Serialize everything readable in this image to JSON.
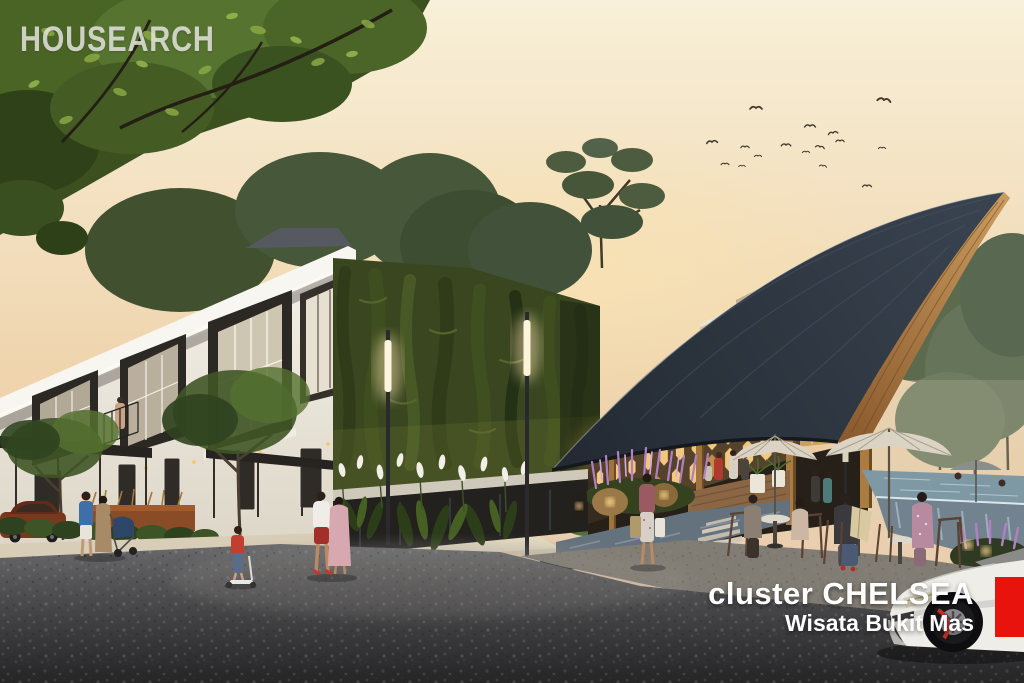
{
  "watermark": {
    "text": "HOUSEARCH"
  },
  "caption": {
    "line1": "cluster CHELSEA",
    "line2": "Wisata Bukit Mas"
  },
  "brand_block": {
    "color": "#e9130d"
  },
  "palette": {
    "sky_top": "#f8f0d8",
    "sky_mid": "#efd4ad",
    "sky_bottom": "#e5cab1",
    "roof_slate": "#3a4450",
    "roof_slate_dark": "#222932",
    "roof_wood_light": "#c89a5c",
    "roof_wood_dark": "#8a5a2e",
    "green_wall": "#39461f",
    "glass_warm": "#e6d2a2",
    "lattice_glow": "#f2c87e",
    "house_white": "#f3f0e8",
    "house_shadow": "#dcd5c6",
    "terrace_floor": "#827d74",
    "road_light": "#6a6a6c",
    "road_dark": "#3a3a3c",
    "pool_water": "#7e98a4",
    "pool_stone": "#72838f",
    "umbrella_cream": "#dbd4c4",
    "car_white": "#efede8",
    "sidewalk": "#d8cdb6",
    "flower_purple": "#b37fc4",
    "flower_white": "#f2efe6",
    "caption_color": "#ffffff",
    "watermark_color": "rgba(240,239,235,0.8)"
  }
}
